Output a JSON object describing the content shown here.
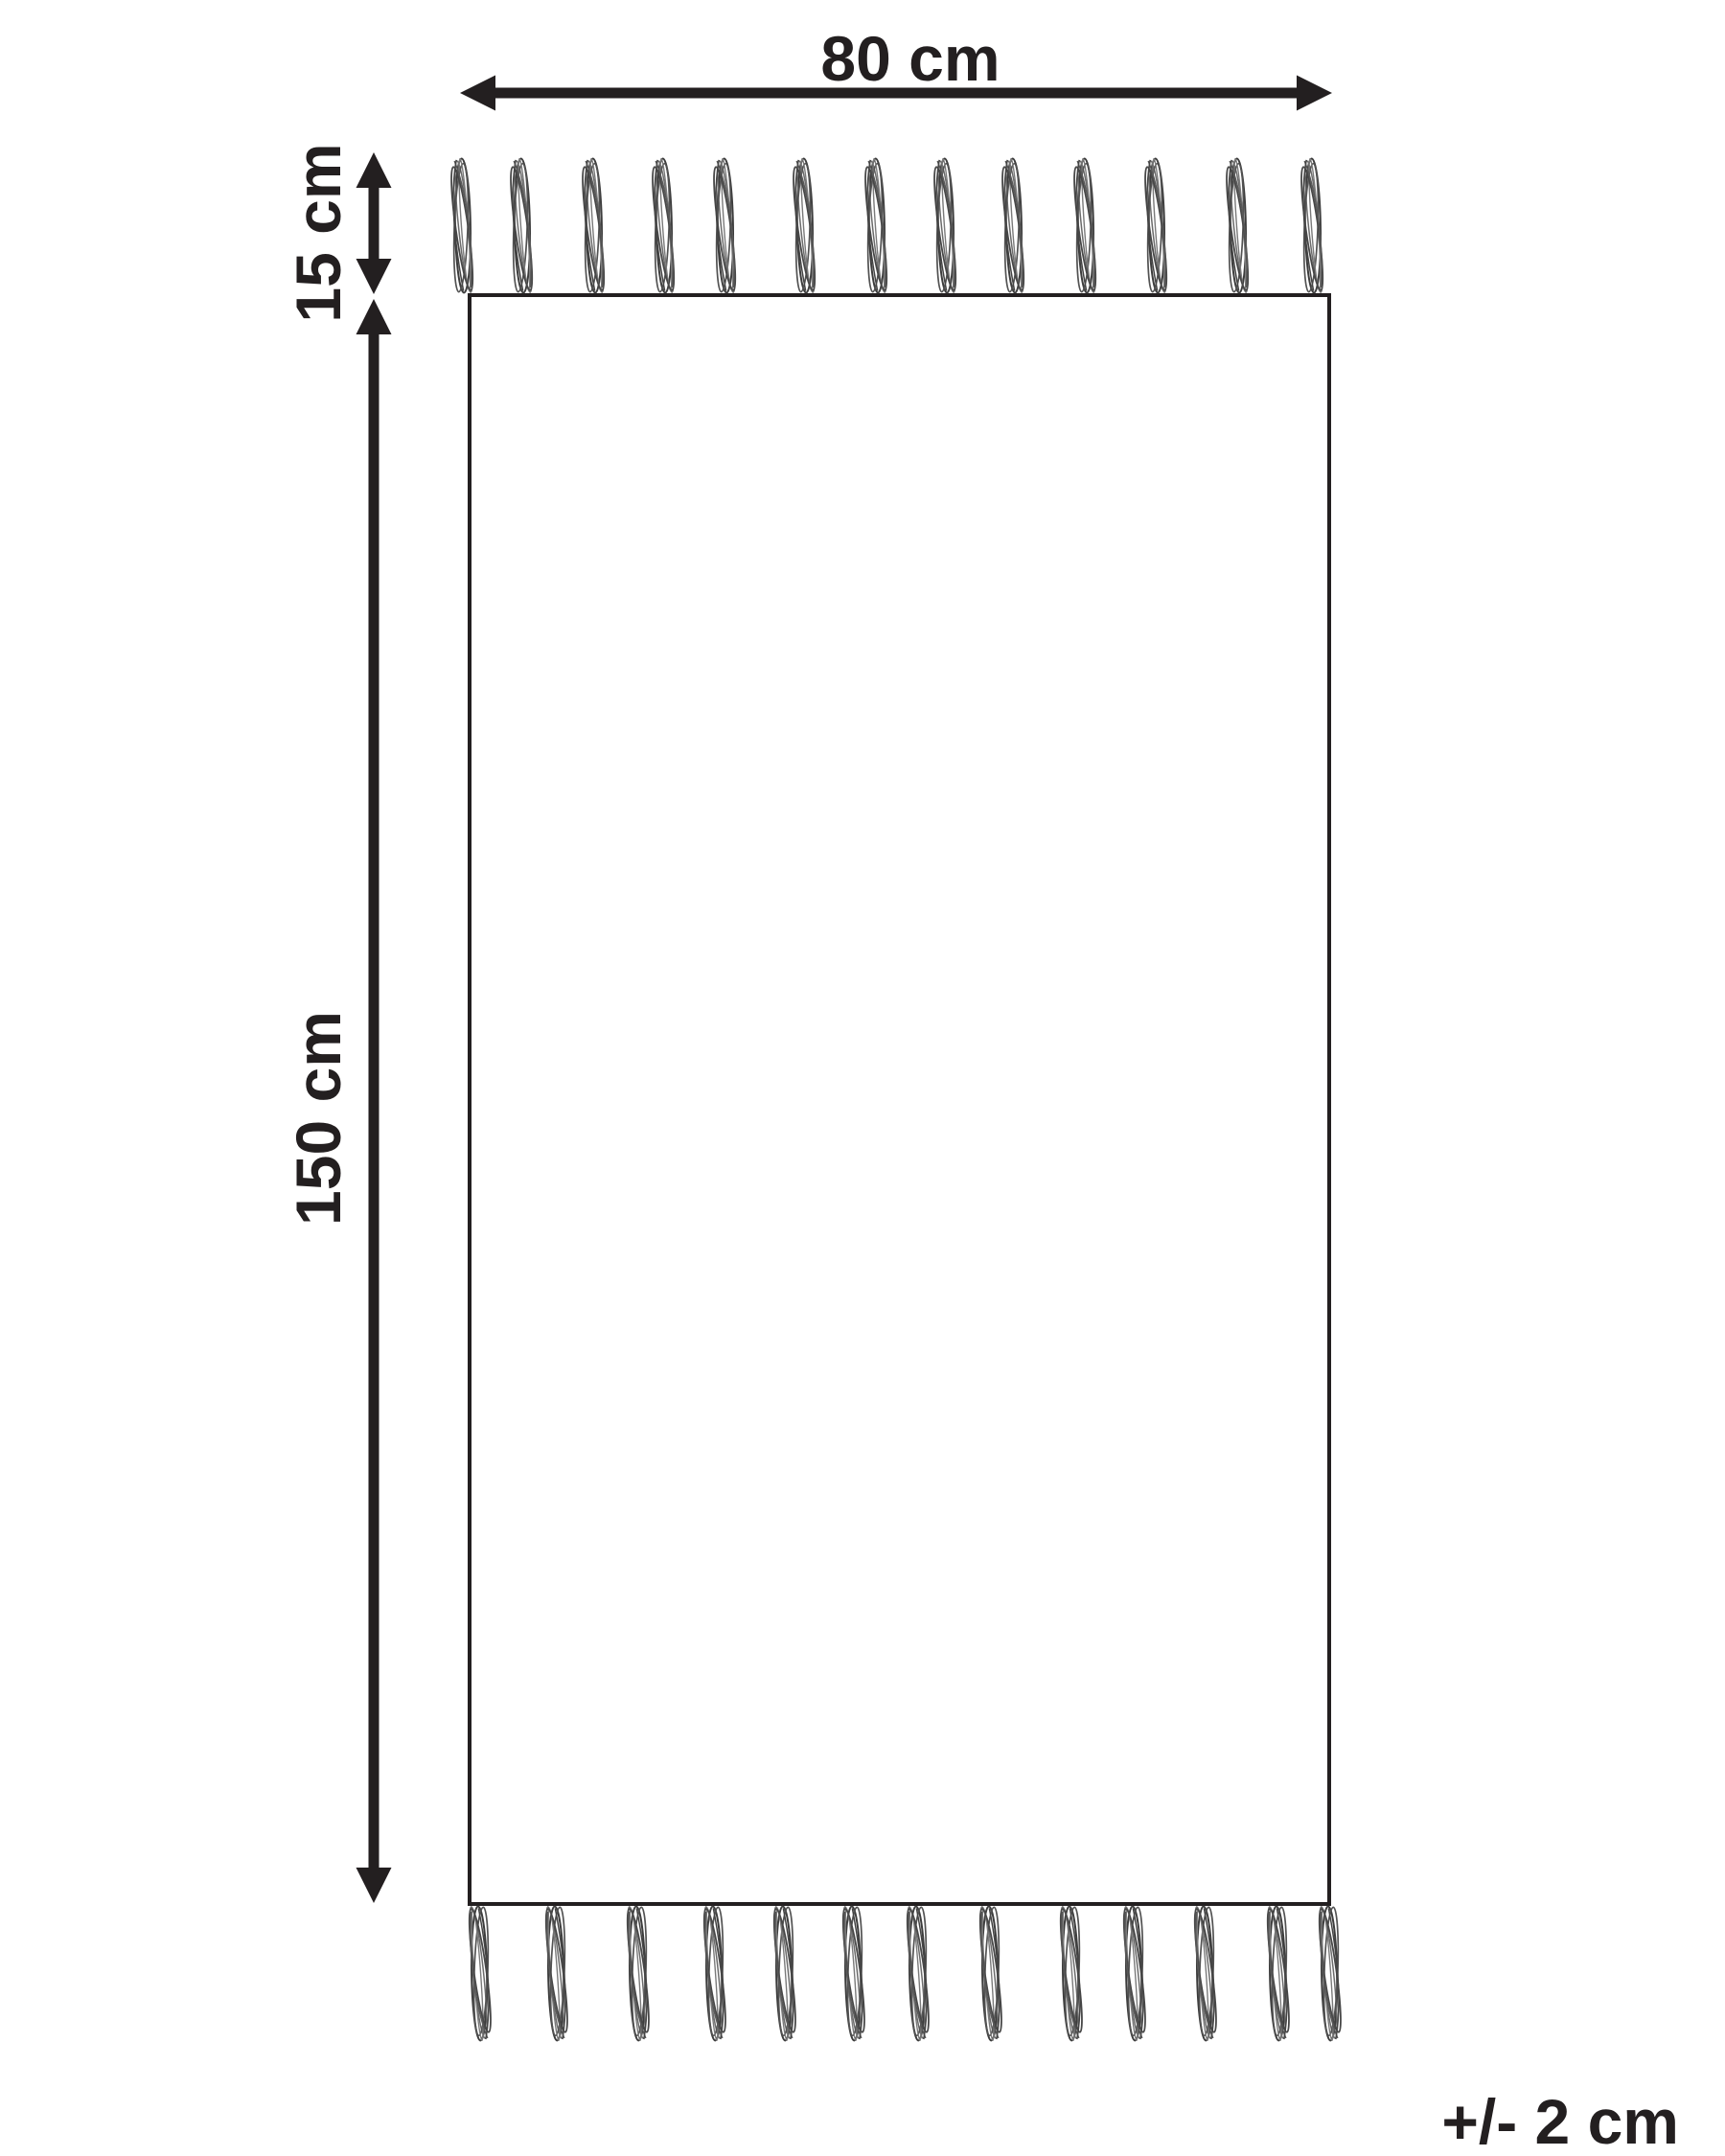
{
  "labels": {
    "width": "80 cm",
    "fringe_height": "15 cm",
    "length": "150 cm",
    "tolerance": "+/- 2 cm"
  },
  "dimensions_cm": {
    "width": 80,
    "length": 150,
    "fringe_height": 15,
    "tolerance_plus_minus": 2
  },
  "fringe": {
    "top_tassel_count": 13,
    "bottom_tassel_count": 13
  },
  "colors": {
    "line": "#231f20",
    "tassel_strand": "#4a4a4a",
    "background": "#ffffff"
  }
}
